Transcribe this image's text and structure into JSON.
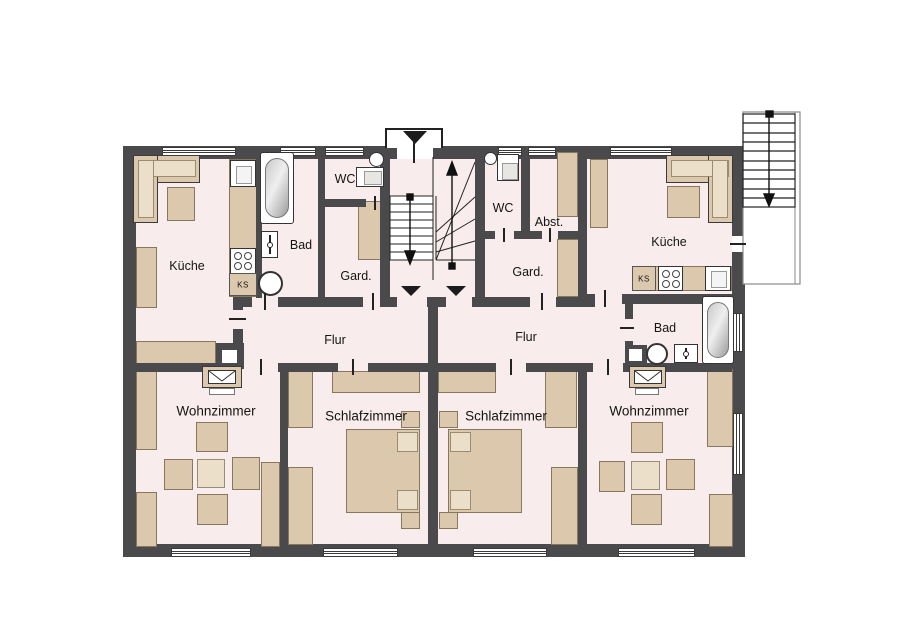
{
  "plan_type": "apartment-floor-plan",
  "apartment_left": {
    "kueche": "Küche",
    "bad": "Bad",
    "wc": "WC",
    "gard": "Gard.",
    "flur": "Flur",
    "wohnzimmer": "Wohnzimmer",
    "schlafzimmer": "Schlafzimmer",
    "ks": "KS"
  },
  "apartment_right": {
    "kueche": "Küche",
    "bad": "Bad",
    "wc": "WC",
    "abst": "Abst.",
    "gard": "Gard.",
    "flur": "Flur",
    "wohnzimmer": "Wohnzimmer",
    "schlafzimmer": "Schlafzimmer",
    "ks": "KS"
  },
  "icons": {
    "stairs": "stairs-icon",
    "entrance_arrow": "entrance-arrow-icon",
    "bathtub": "bathtub-icon",
    "toilet": "toilet-icon",
    "washbasin": "washbasin-icon",
    "washing_machine": "washing-machine-icon",
    "stove": "stove-icon",
    "sink": "sink-icon",
    "tv": "tv-icon",
    "chimney": "chimney-icon"
  },
  "colors": {
    "wall": "#4a4a4c",
    "floor": "#f8edec",
    "furniture": "#dbc8ad",
    "furniture_light": "#ecdfc9",
    "background": "#ffffff",
    "line": "#222222"
  }
}
